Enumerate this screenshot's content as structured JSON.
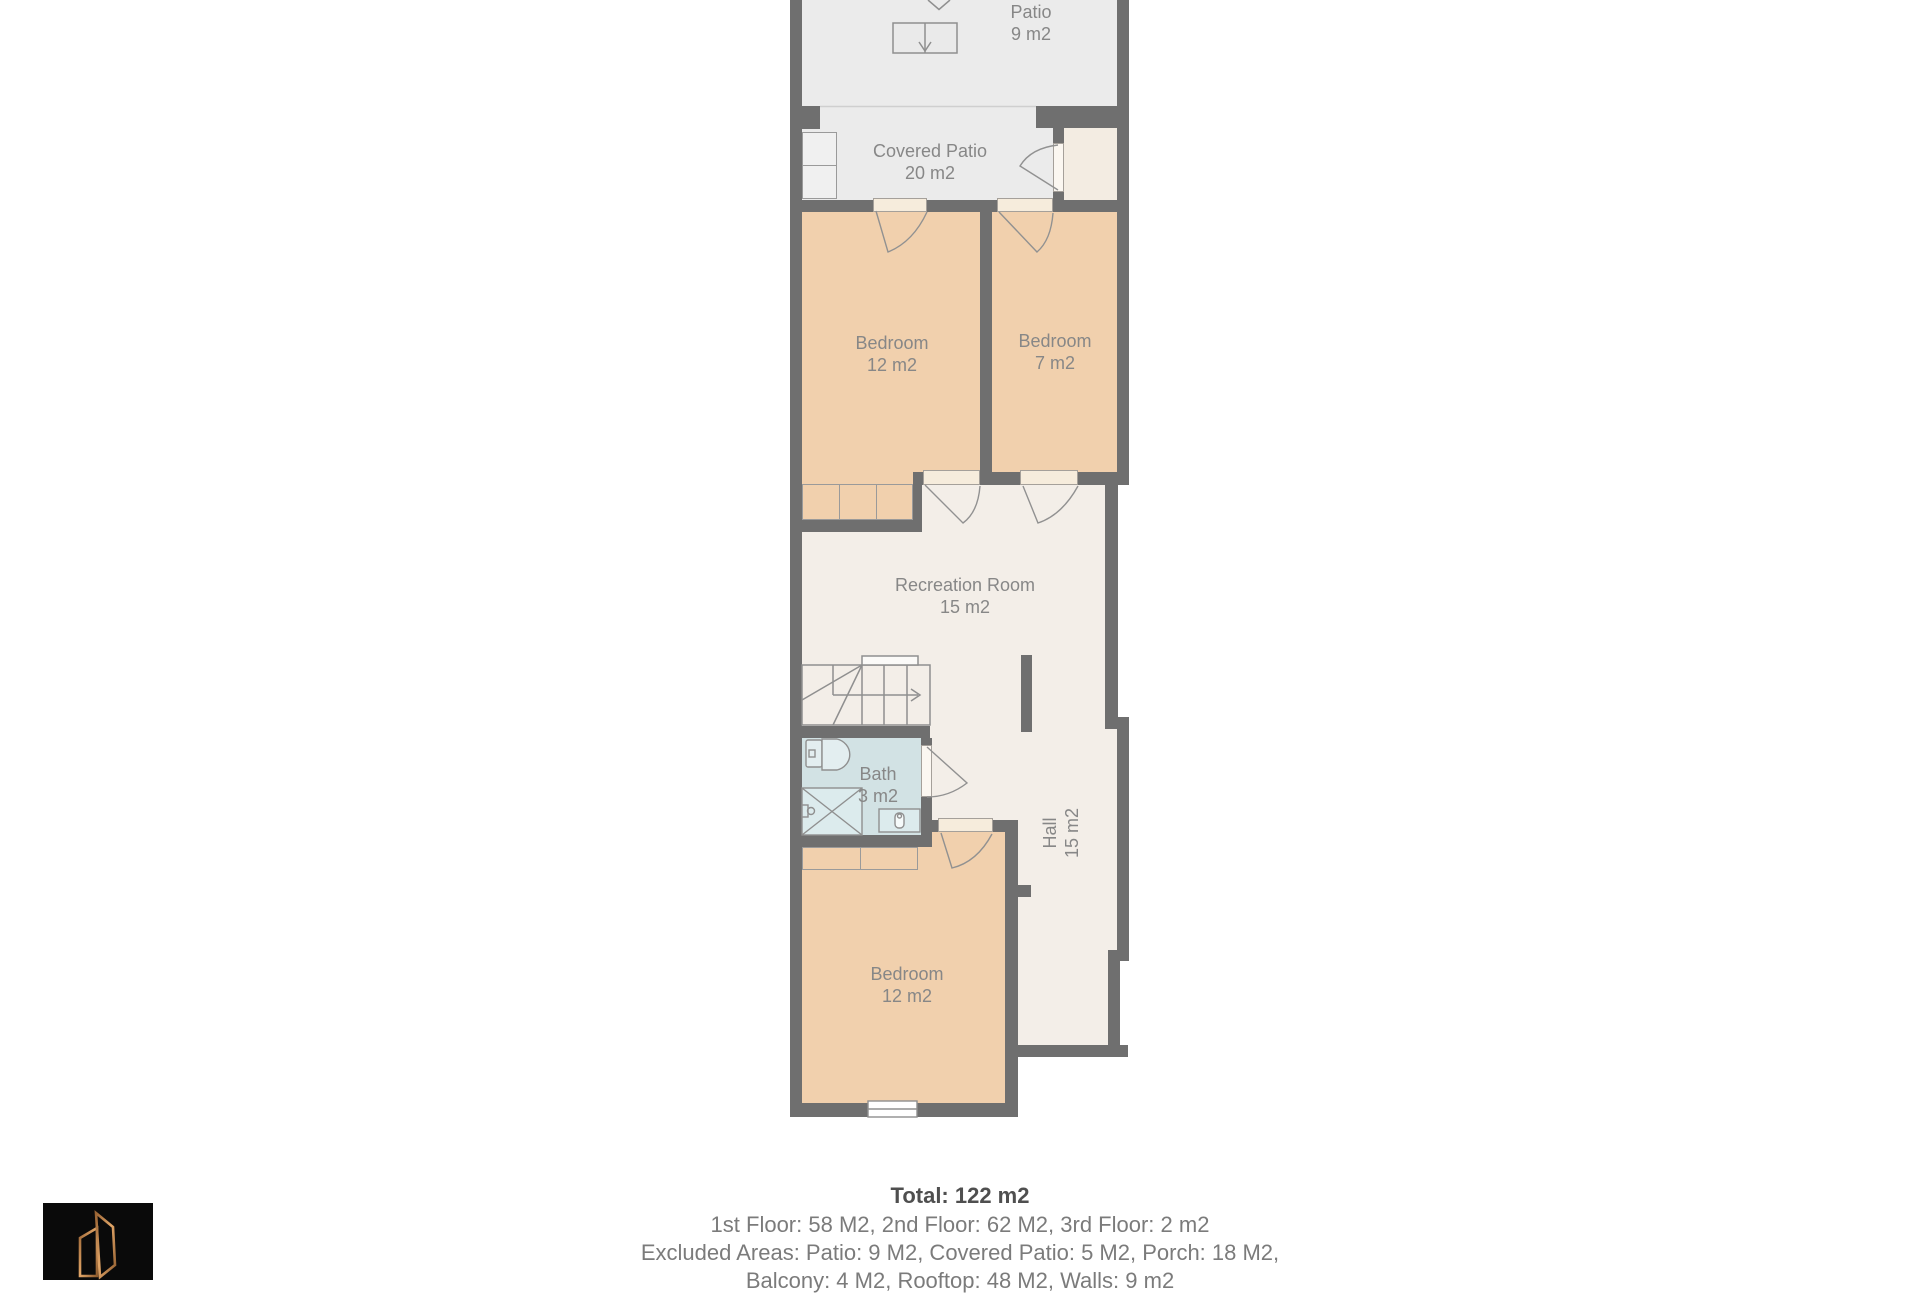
{
  "rooms": [
    {
      "id": "patio",
      "name": "Patio",
      "area": "9 m2"
    },
    {
      "id": "covered-patio",
      "name": "Covered Patio",
      "area": "20 m2"
    },
    {
      "id": "bedroom-1",
      "name": "Bedroom",
      "area": "12 m2"
    },
    {
      "id": "bedroom-2",
      "name": "Bedroom",
      "area": "7 m2"
    },
    {
      "id": "recreation",
      "name": "Recreation Room",
      "area": "15 m2"
    },
    {
      "id": "bath",
      "name": "Bath",
      "area": "3 m2"
    },
    {
      "id": "hall",
      "name": "Hall",
      "area": "15 m2"
    },
    {
      "id": "bedroom-3",
      "name": "Bedroom",
      "area": "12 m2"
    }
  ],
  "summary": {
    "total": "Total: 122 m2",
    "lines": [
      "1st Floor: 58 M2, 2nd Floor: 62 M2, 3rd Floor: 2 m2",
      "Excluded Areas: Patio: 9 M2, Covered Patio: 5 M2, Porch: 18 M2,",
      "Balcony: 4 M2, Rooftop: 48 M2, Walls: 9 m2"
    ]
  },
  "colors": {
    "wall": "#6f6f6f",
    "patio_fill": "#ebebeb",
    "floor_fill": "#f3eee8",
    "bedroom_fill": "#f1d0ad",
    "bath_fill": "#d2e2e4",
    "threshold_fill": "#f6ecdc",
    "label_text": "#878787",
    "summary_bold_text": "#4f4f4f",
    "summary_text": "#7b7b7b",
    "logo_background": "#0a0a0a",
    "logo_accent": "#c08552"
  },
  "icons": {
    "stairs_down": "boxed-down-arrow",
    "staircase": "steps-with-direction-arrow",
    "door": "quarter-arc-swing",
    "window": "double-line-window",
    "toilet": "toilet-top-view",
    "shower": "crossed-square-shower",
    "sink": "basin-top-view",
    "logo": "copper-door-buildings"
  }
}
